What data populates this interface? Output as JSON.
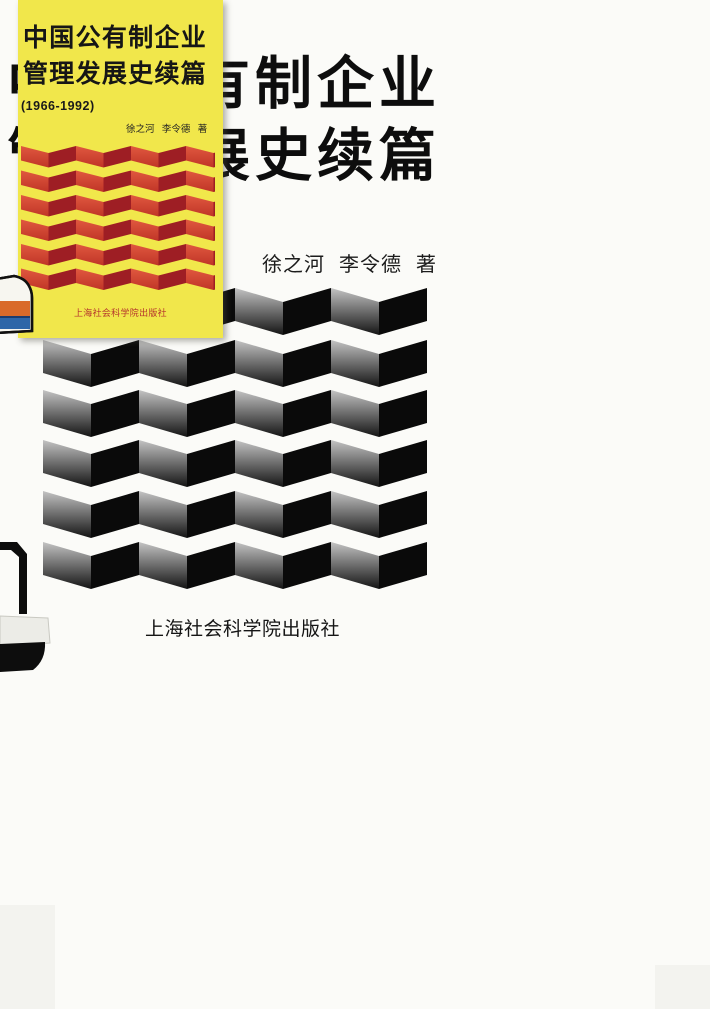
{
  "book_cover": {
    "main": {
      "title_line1": "中国公有制企业",
      "title_line2": "管理发展史续篇",
      "authors": "徐之河 李令德 著",
      "publisher": "上海社会科学院出版社"
    },
    "inset": {
      "title_line1": "中国公有制企业",
      "title_line2": "管理发展史续篇",
      "years": "(1966-1992)",
      "authors": "徐之河 李令德 著",
      "publisher": "上海社会科学院出版社"
    }
  },
  "patterns": {
    "large_zigzag": {
      "rows": 6,
      "periods": 4,
      "light_face_top": "#c3c3c3",
      "light_face_bottom": "#141414",
      "dark_face": "#0a0a0a"
    },
    "inset_zigzag": {
      "rows": 6,
      "periods": 4,
      "light_face_top": "#e0583f",
      "light_face_bottom": "#c03527",
      "dark_face": "#9e1e24"
    }
  },
  "colors": {
    "paper": "#fbfbf8",
    "card_yellow": "#f1e74b",
    "ink": "#0d0d0d",
    "card_publisher_red": "#b5352c",
    "object_orange": "#d96a2a",
    "object_blue": "#2e66a8"
  }
}
